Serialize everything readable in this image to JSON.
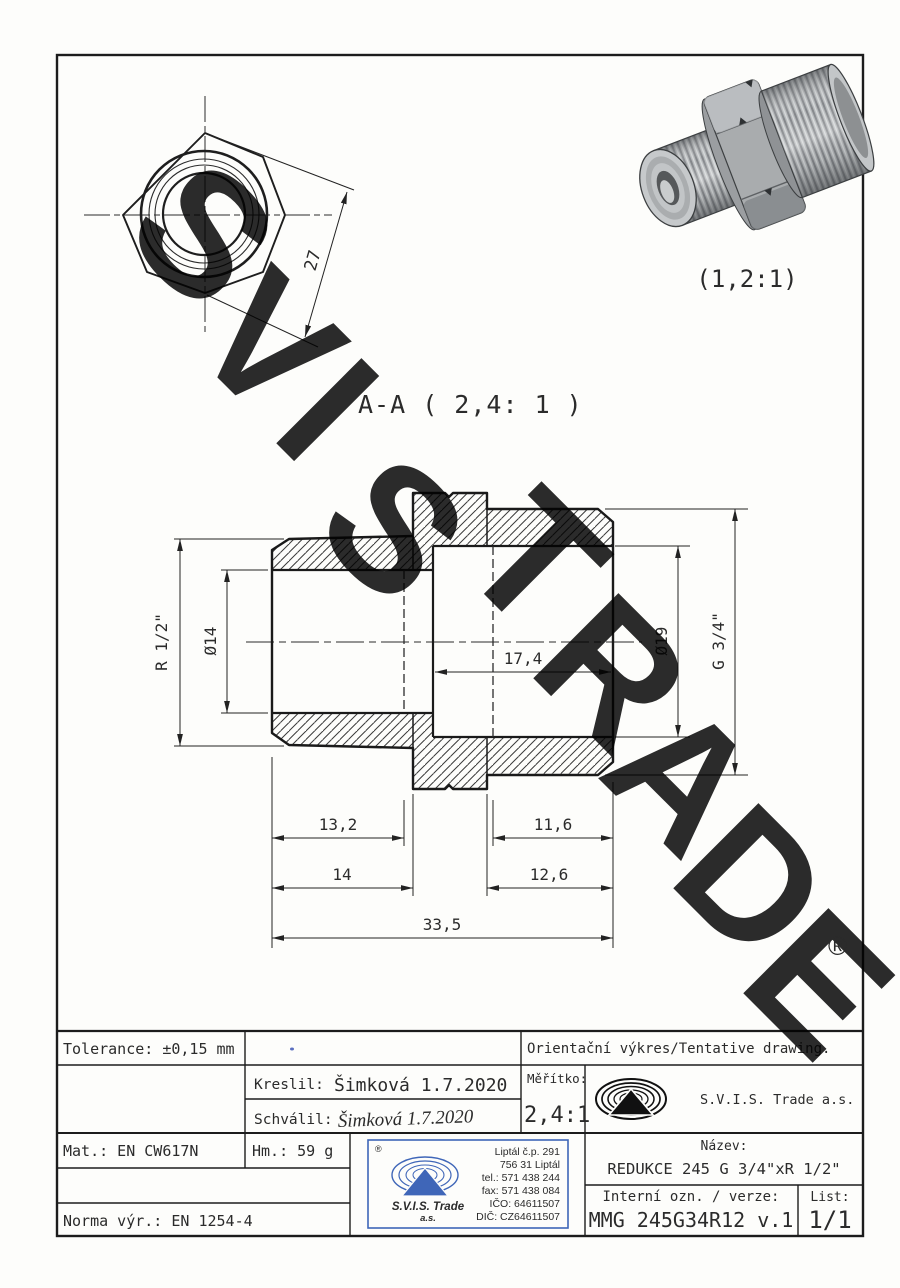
{
  "watermark": {
    "svis": [
      "S",
      "V",
      "I",
      "S"
    ],
    "trade": [
      "T",
      "R",
      "A",
      "D",
      "E"
    ],
    "registered": "®",
    "grey": "#d7d7d7",
    "gold": "#f1c452",
    "gold_light": "#f6dc9b"
  },
  "top_view": {
    "dim_across_flats": "27"
  },
  "pictorial": {
    "scale_label": "(1,2:1)"
  },
  "section": {
    "title": "A-A ( 2,4: 1 )",
    "dims": {
      "left_thread": "R 1/2\"",
      "left_bore": "Ø14",
      "bore_depth": "17,4",
      "right_bore": "Ø19",
      "right_thread": "G 3/4\"",
      "thread_len_left": "13,2",
      "len_left": "14",
      "thread_len_right": "11,6",
      "len_right": "12,6",
      "total_len": "33,5"
    }
  },
  "title_block": {
    "tolerance": "Tolerance: ±0,15 mm",
    "orientation_note": "Orientační výkres/Tentative drawing.",
    "kreslil_label": "Kreslil:",
    "kreslil_value": "Šimková 1.7.2020",
    "schvalil_label": "Schválil:",
    "schvalil_signature": "Šimková 1.7.2020",
    "meritko_label": "Měřítko:",
    "meritko_value": "2,4:1",
    "company": "S.V.I.S. Trade a.s.",
    "mat": "Mat.: EN CW617N",
    "hm": "Hm.: 59 g",
    "norma": "Norma výr.: EN 1254-4",
    "nazev_label": "Název:",
    "nazev_value": "REDUKCE 245 G 3/4\"xR 1/2\"",
    "interni_label": "Interní ozn. / verze:",
    "interni_value": "MMG 245G34R12 v.1",
    "list_label": "List:",
    "list_value": "1/1",
    "stamp": {
      "registered": "®",
      "company_line1": "S.V.I.S. Trade",
      "company_line2": "a.s.",
      "address": [
        "Liptál č.p. 291",
        "756 31 Liptál",
        "tel.: 571 438 244",
        "fax: 571 438 084",
        "IČO: 64611507",
        "DIČ: CZ64611507"
      ],
      "color": "#3f66b8"
    }
  }
}
